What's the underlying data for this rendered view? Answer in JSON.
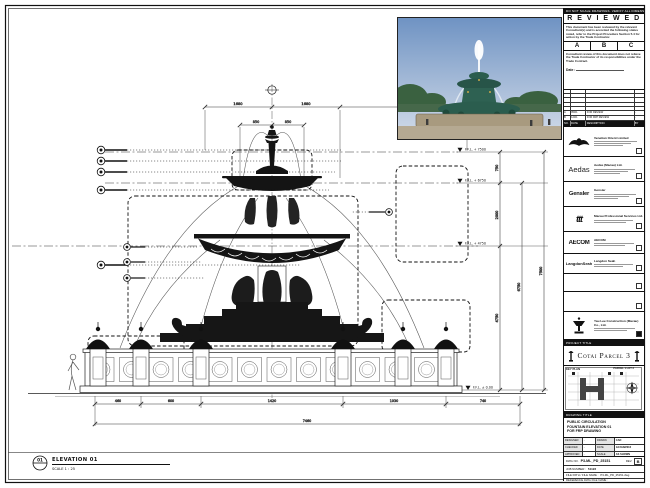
{
  "stamp": {
    "top_note": "DO NOT SCALE DRAWINGS. VERIFY ALL DIMENSIONS ON SITE.",
    "title": "R E V I E W E D",
    "para1": "This document has been reviewed by the relevant Consultant(s) and is accorded the following status noted, refer to the Project Procedure Section 5.4 for action by the Trade Contractor.",
    "grades": [
      "A",
      "B",
      "C"
    ],
    "para2": "Consultant review of this document does not relieve the Trade Contractor of its responsibilities under the Trade Contract.",
    "date_label": "Date :"
  },
  "revisions": {
    "headers": [
      "NO.",
      "DATE",
      "DESCRIPTION",
      "BY"
    ],
    "rows": [
      {
        "no": "A",
        "date": "05/01",
        "desc": "FOR REVIEW",
        "by": "-"
      },
      {
        "no": "B",
        "date": "12/01",
        "desc": "FOR FRP REVIEW",
        "by": "-"
      }
    ]
  },
  "consultants": [
    {
      "logo": "",
      "name": "Venetian Orient Limited"
    },
    {
      "logo": "Aedas",
      "name": "Aedas (Macau) Ltd."
    },
    {
      "logo": "Gensler",
      "name": "Gensler"
    },
    {
      "logo": "ttt",
      "name": "Macau Professional Services Ltd."
    },
    {
      "logo": "AECOM",
      "name": "AECOM"
    },
    {
      "logo": "LangdonSeah",
      "name": "Langdon Seah"
    },
    {
      "logo": "",
      "name": ""
    },
    {
      "logo": "",
      "name": ""
    },
    {
      "logo": "",
      "name": "Yau Lee Construction (Macau) Co., Ltd."
    }
  ],
  "project": {
    "label": "PROJECT TITLE",
    "name": "Cotai Parcel 3"
  },
  "key_plan": {
    "label": "KEY PLAN",
    "parcel_label": "PARCEL 1 LOT 2"
  },
  "drawing_title": {
    "label": "DRAWING TITLE",
    "line1": "PUBLIC CIRCULATION",
    "line2": "FOUNTAIN ELEVATION 01",
    "line3": "FOR FRP DRAWING"
  },
  "fields": {
    "designed_label": "DESIGNED",
    "designed": "-",
    "drawn_label": "DRAWN",
    "drawn": "CAD",
    "checked_label": "CHECKED",
    "checked": "-",
    "date_label": "DATE",
    "date": "12/JAN/2016",
    "approved_label": "APPROVED",
    "approved": "-",
    "scale_label": "SCALE",
    "scale": "AS SHOWN"
  },
  "doc": {
    "dwg_label": "DWG NO.",
    "dwg_no": "P3-ML_PD_25151",
    "rev_label": "REV.",
    "rev": "B",
    "job_label": "JOB NUMBER :",
    "job": "51123",
    "file_label": "FILE PATH / FILE NAME :",
    "file": "P3-ML_PD_25151.dwg",
    "ref_label": "REFERENCE DWG FILE NAME :",
    "ref": ""
  },
  "drawing": {
    "callout_number": "01",
    "title": "ELEVATION 01",
    "scale_note": "SCALE  1 : 25",
    "levels": [
      "F.F.L. + 7500",
      "F.F.L. + 6750",
      "F.F.L. + 4750",
      "F.F.L. ± 0.00"
    ],
    "dims": {
      "t1": "1680",
      "t2": "1680",
      "t3": "3180",
      "m1": "850",
      "m2": "850",
      "v1": "750",
      "v2": "2000",
      "v3": "4750",
      "v4": "6750",
      "v5": "7500",
      "b1": "460",
      "b2": "600",
      "b3": "1420",
      "b4": "1030",
      "b5": "740",
      "overall": "7460"
    }
  }
}
